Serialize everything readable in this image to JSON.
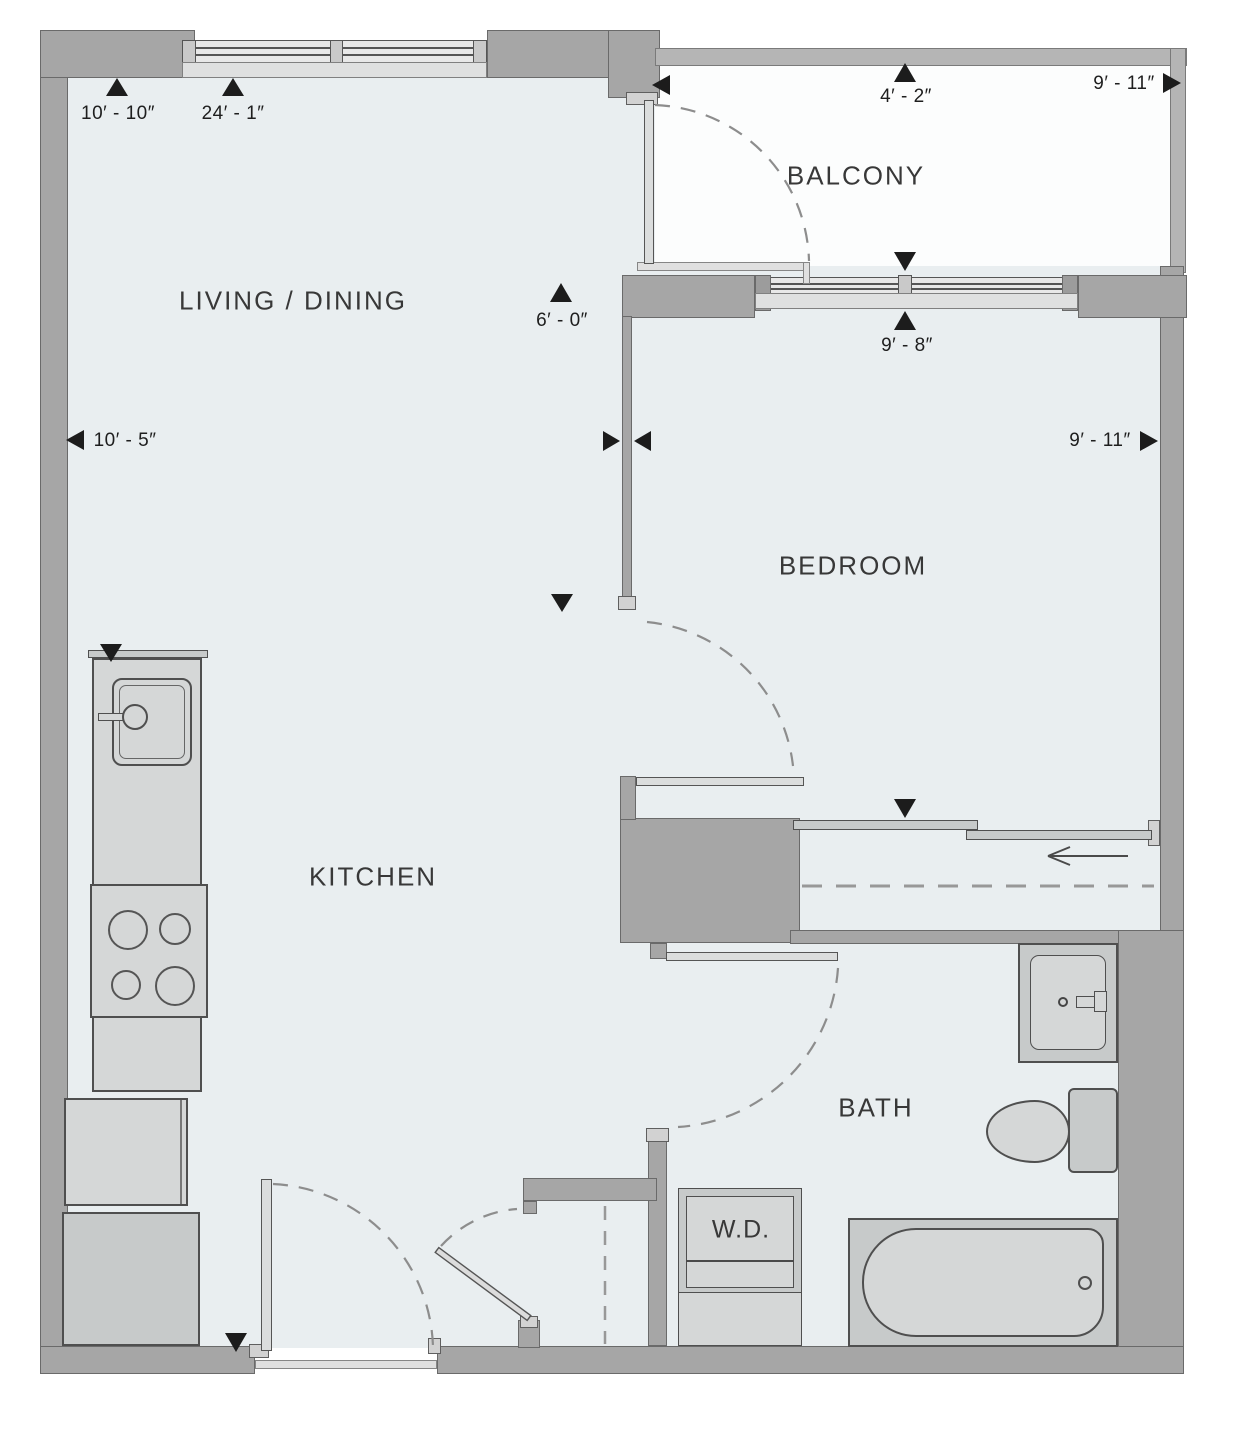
{
  "title": "Apartment floor plan",
  "rooms": {
    "living": {
      "label": "LIVING / DINING"
    },
    "balcony": {
      "label": "BALCONY"
    },
    "bedroom": {
      "label": "BEDROOM"
    },
    "kitchen": {
      "label": "KITCHEN"
    },
    "bath": {
      "label": "BATH"
    },
    "wd": {
      "label": "W.D."
    }
  },
  "dims": {
    "living_depth": "10′ - 10″",
    "unit_depth": "24′ - 1″",
    "balcony_depth": "4′ - 2″",
    "balcony_width": "9′ - 11″",
    "bedroom_depth": "9′ - 8″",
    "living_width": "10′ - 5″",
    "bedroom_width": "9′ - 11″",
    "opening_width": "6′ - 0″"
  },
  "colors": {
    "wall": "#a6a6a6",
    "floor": "#e9eef0",
    "balcony_floor": "#fcfdfd",
    "fixture_light": "#d5d7d7",
    "fixture_mid": "#c7caca",
    "outline": "#4f4f4f",
    "dash": "#8d8d8d",
    "text": "#383838",
    "marker": "#1c1c1c"
  }
}
